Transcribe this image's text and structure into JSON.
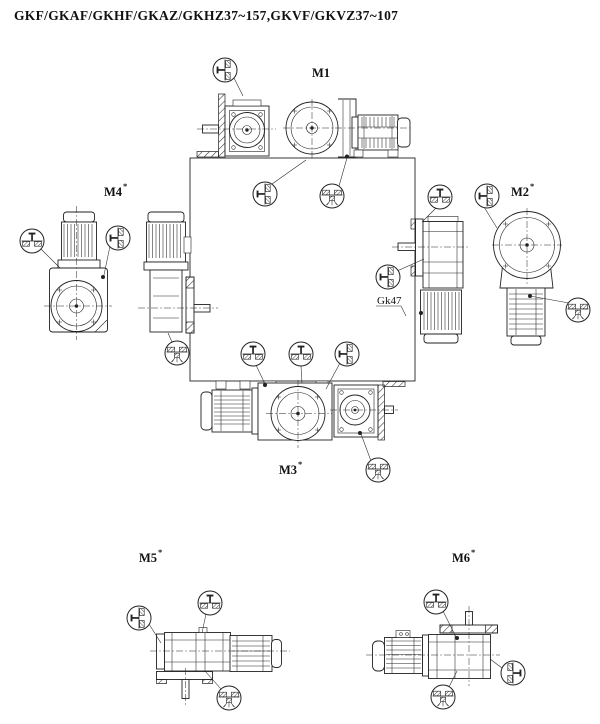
{
  "title": "GKF/GKAF/GKHF/GKAZ/GKHZ37~157,GKVF/GKVZ37~107",
  "note_label": "Gk47",
  "positions": {
    "m1": {
      "label": "M1",
      "marker": ""
    },
    "m2": {
      "label": "M2",
      "marker": "*"
    },
    "m3": {
      "label": "M3",
      "marker": "*"
    },
    "m4": {
      "label": "M4",
      "marker": "*"
    },
    "m5": {
      "label": "M5",
      "marker": "*"
    },
    "m6": {
      "label": "M6",
      "marker": "*"
    }
  },
  "icons": {
    "oil-level-up-icon": "circle, horizontal oil surface, hatched oil below, vent plug on top",
    "oil-level-left-icon": "oil level symbol rotated 90°, plug pointing left, oil hatched at right",
    "oil-level-right-icon": "oil level symbol rotated 90°, plug pointing right, oil hatched at left",
    "oil-drain-down-icon": "inverted symbol, hatched oil at top, drain plug with drips below"
  },
  "colors": {
    "ink": "#222222",
    "paper": "#ffffff"
  }
}
